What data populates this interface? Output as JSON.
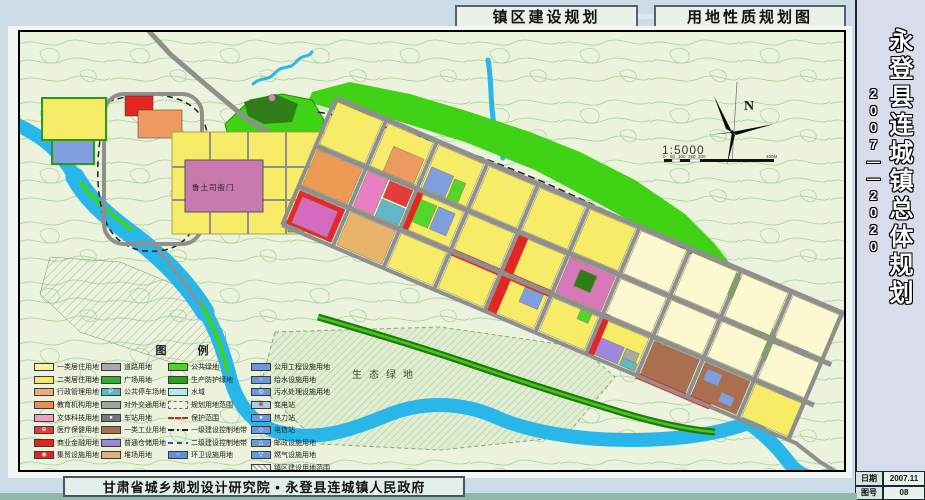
{
  "header": {
    "tab_construction": "镇区建设规划",
    "tab_landuse": "用地性质规划图"
  },
  "titleblock": {
    "title": "永登县连城镇总体规划",
    "period": "2007——2020",
    "date_label": "日期",
    "date_value": "2007.11",
    "sheet_label": "图号",
    "sheet_value": "08"
  },
  "footer": {
    "credit": "甘肃省城乡规划设计研究院 • 永登县连城镇人民政府"
  },
  "map": {
    "north_label": "N",
    "scale_text": "1:5000",
    "scale_ticks": [
      "0",
      "50",
      "100",
      "150",
      "200",
      "400M"
    ],
    "labels": {
      "eco_green": "生态绿地",
      "heritage": "鲁土司衙门"
    },
    "colors": {
      "terrain_bg": "#ebf3dc",
      "contour": "#a8cf9e",
      "river": "#29b6e8",
      "hill_green": "#3fd215",
      "forest_dark": "#2f7d17",
      "road": "#8f8f8f"
    }
  },
  "legend": {
    "title": "图  例",
    "columns": [
      {
        "items": [
          {
            "label": "一类居住用地",
            "color": "#fdf29e",
            "symbol": ""
          },
          {
            "label": "二类居住用地",
            "color": "#f7ea62",
            "symbol": ""
          },
          {
            "label": "行政管理用地",
            "color": "#f2a87e",
            "symbol": ""
          },
          {
            "label": "教育机构用地",
            "color": "#ee8a55",
            "symbol": ""
          },
          {
            "label": "文体科技用地",
            "color": "#efa0c4",
            "symbol": ""
          },
          {
            "label": "医疗保健用地",
            "color": "#e43b3b",
            "symbol": "⊕"
          },
          {
            "label": "商业金融用地",
            "color": "#e6231f",
            "symbol": ""
          },
          {
            "label": "集贸设施用地",
            "color": "#e6231f",
            "symbol": "◉"
          }
        ]
      },
      {
        "items": [
          {
            "label": "道路用地",
            "color": "#ababab",
            "symbol": ""
          },
          {
            "label": "广场用地",
            "color": "#2fae3c",
            "symbol": ""
          },
          {
            "label": "公共停车场地",
            "color": "#5fb9cb",
            "symbol": "P"
          },
          {
            "label": "对外交通用地",
            "color": "#9aa99b",
            "symbol": ""
          },
          {
            "label": "车站用地",
            "color": "#6e7b86",
            "symbol": "●"
          },
          {
            "label": "一类工业用地",
            "color": "#aa6f4e",
            "symbol": ""
          },
          {
            "label": "普通仓储用地",
            "color": "#9e86df",
            "symbol": ""
          },
          {
            "label": "堆场用地",
            "color": "#dcb277",
            "symbol": ""
          }
        ]
      },
      {
        "items": [
          {
            "label": "公共绿地",
            "color": "#4ed321",
            "symbol": ""
          },
          {
            "label": "生产防护绿地",
            "color": "#2ba21c",
            "symbol": ""
          },
          {
            "label": "水域",
            "color": "#b4e9f2",
            "symbol": ""
          },
          {
            "label": "规划用地范围",
            "color": "",
            "symbol": ""
          },
          {
            "label": "保护范围",
            "color": "",
            "symbol": ""
          },
          {
            "label": "一级建设控制地带",
            "color": "",
            "symbol": ""
          },
          {
            "label": "二级建设控制地带",
            "color": "",
            "symbol": ""
          },
          {
            "label": "环卫设施用地",
            "color": "#5f8fdd",
            "symbol": "○"
          }
        ]
      },
      {
        "items": [
          {
            "label": "公用工程设施用地",
            "color": "#6b99e0",
            "symbol": ""
          },
          {
            "label": "给水设施用地",
            "color": "#6b99e0",
            "symbol": "○"
          },
          {
            "label": "污水处理设施用地",
            "color": "#6b99e0",
            "symbol": "◎"
          },
          {
            "label": "变电站",
            "color": "#a7cbe8",
            "symbol": "⊗"
          },
          {
            "label": "热力站",
            "color": "#6b99e0",
            "symbol": "●"
          },
          {
            "label": "电信站",
            "color": "#6b99e0",
            "symbol": "◇"
          },
          {
            "label": "邮政设施用地",
            "color": "#6b99e0",
            "symbol": "△"
          },
          {
            "label": "燃气设施用地",
            "color": "#6b99e0",
            "symbol": "▽"
          },
          {
            "label": "镇区建设用地范围",
            "color": "",
            "symbol": ""
          }
        ]
      }
    ]
  }
}
